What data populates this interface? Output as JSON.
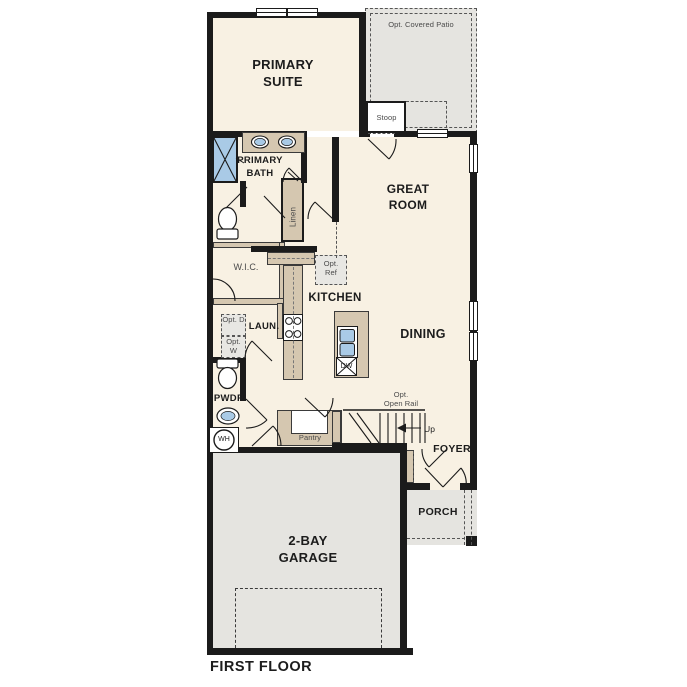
{
  "title": "FIRST FLOOR",
  "colors": {
    "cream": "#f8f1e3",
    "tan": "#d5c7b0",
    "gray": "#e5e4e0",
    "blue": "#a9cae6",
    "wall": "#1b1b1b",
    "label": "#1c1c1c",
    "smlabel": "#4a4a4a",
    "dash": "#555555"
  },
  "rooms": {
    "primary_suite": "PRIMARY SUITE",
    "primary_bath": "PRIMARY BATH",
    "great_room": "GREAT ROOM",
    "wic": "W.I.C.",
    "kitchen": "KITCHEN",
    "dining": "DINING",
    "laundry": "LAUN.",
    "powder": "PWDR",
    "foyer": "FOYER",
    "porch": "PORCH",
    "garage": "2-BAY GARAGE"
  },
  "annotations": {
    "opt_covered_patio": "Opt. Covered Patio",
    "stoop": "Stoop",
    "linen": "Linen",
    "opt_ref": "Opt. Ref",
    "opt_d": "Opt. D",
    "opt_w": "Opt. W",
    "pantry": "Pantry",
    "opt_open_rail_line1": "Opt.",
    "opt_open_rail_line2": "Open Rail",
    "up": "Up",
    "wh": "WH",
    "dw": "DW"
  }
}
